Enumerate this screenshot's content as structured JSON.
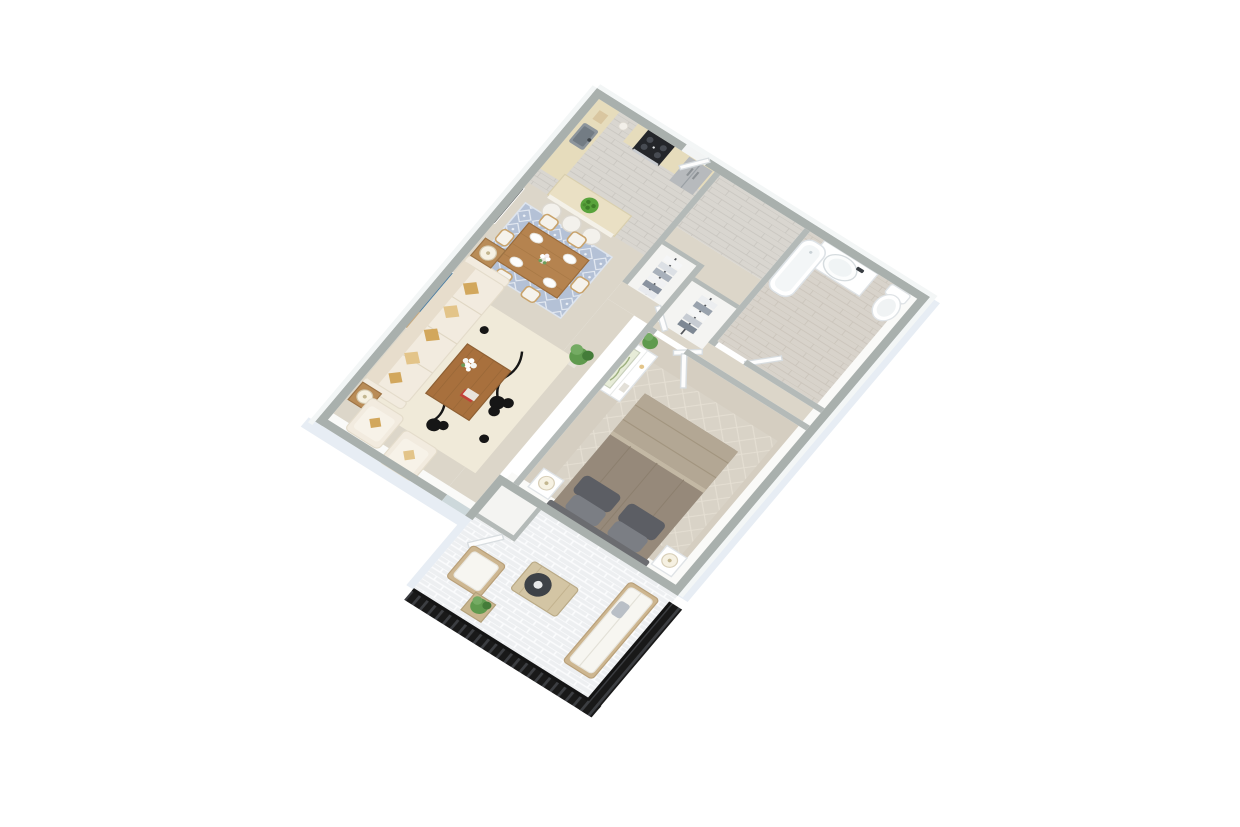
{
  "scene": {
    "kind": "3d-floorplan-render",
    "background": "#ffffff",
    "rooms": [
      "kitchen",
      "dining-area",
      "living-room",
      "hallway-closets",
      "bathroom",
      "bedroom",
      "patio"
    ]
  },
  "palette": {
    "bg": "#ffffff",
    "wallTop": "#a9b0ad",
    "wallTopIn": "#b4bab8",
    "wallFace": "#f3f6f6",
    "wallFaceIn": "#fafaf8",
    "slabSide": "#e7edf4",
    "woodFloor": "#d9d6d0",
    "woodLine": "#c6c3bd",
    "bathFloor": "#d8d3cb",
    "bathLine": "#c8c2b8",
    "carpet": "#dcd6c9",
    "carpetBed": "#d5cec1",
    "closetFloor": "#f4f4f2",
    "brick": "#edeff1",
    "brickLine": "#fbfcfd",
    "railing": "#191919",
    "railingSlat": "#3c3e42",
    "counter": "#e6dcbc",
    "islandTop": "#eae0c4",
    "stove": "#24262a",
    "steel": "#b7babd",
    "steelDark": "#9aa0a5",
    "sink": "#8d959c",
    "sinkIn": "#737c84",
    "cream": "#f5f2ec",
    "sofa": "#f2ebdf",
    "sofaShade": "#e7ddcc",
    "sofaEdge": "#e4dccb",
    "gold": "#d2a75c",
    "goldLight": "#e3c489",
    "woodTable": "#a8703d",
    "woodTableTop": "#b5834f",
    "woodLight": "#c9a36b",
    "rugLiving": "#f0ead9",
    "rugDining": "#b4c1d6",
    "rugBed": "#d9d3c7",
    "rugBedLine": "#e5dfd3",
    "ink": "#161616",
    "artBlue": "#4d7da1",
    "artSand": "#c9a87c",
    "artDark": "#2f2f2f",
    "botanical": "#e7ecd8",
    "botanicalInk": "#9db07e",
    "duvet": "#96897a",
    "blanket": "#b3a794",
    "pillowDark": "#5c5e64",
    "pillowMid": "#7b7e84",
    "headboard": "#6b6c70",
    "green": "#5f9a4e",
    "greenDark": "#447c39",
    "greenLight": "#74ab63",
    "lampShade": "#f6f1e2",
    "doorWhite": "#fdfdfd",
    "doorEdge": "#d8dde0",
    "fixtureEdge": "#dfe3e6",
    "glassDoor": "#cdd8db",
    "patioWood": "#cdb690",
    "patioWoodEdge": "#b89f78",
    "patioCushion": "#f7f6f1"
  }
}
